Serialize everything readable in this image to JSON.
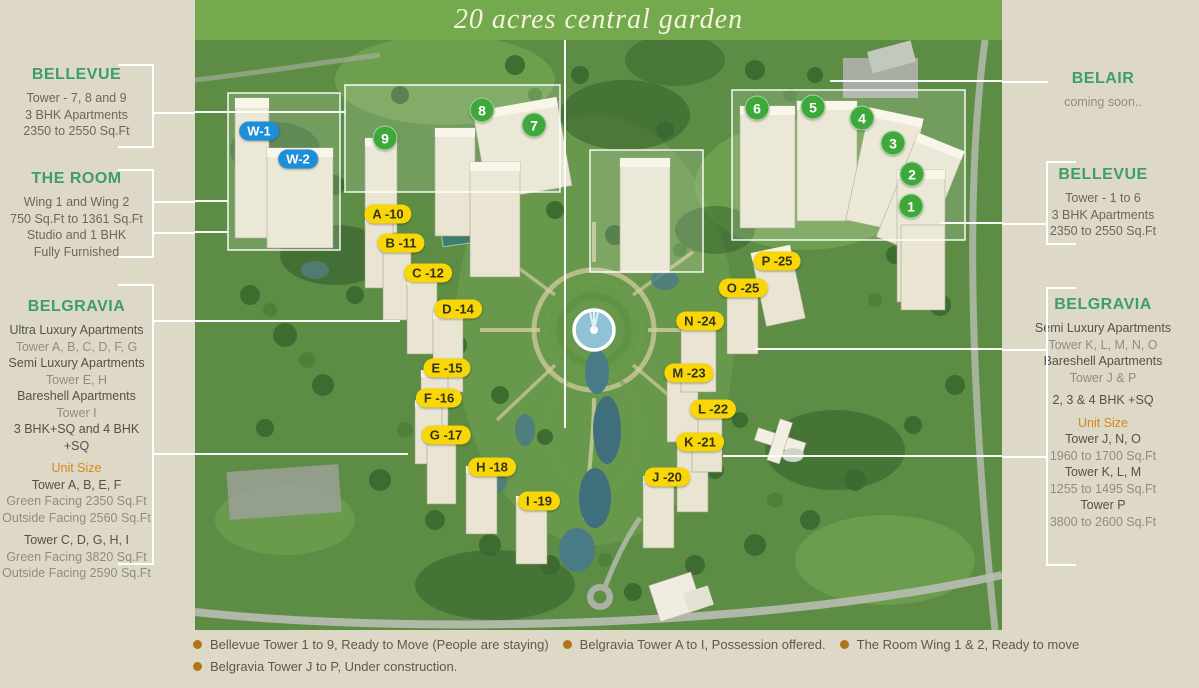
{
  "banner": {
    "title": "20 acres central garden"
  },
  "panels": {
    "left": [
      {
        "id": "bellevue-left",
        "heading": "BELLEVUE",
        "top": 66,
        "lines": [
          {
            "text": "Tower - 7, 8 and 9",
            "tone": "body"
          },
          {
            "text": "3 BHK Apartments",
            "tone": "body"
          },
          {
            "text": "2350 to 2550 Sq.Ft",
            "tone": "body"
          }
        ]
      },
      {
        "id": "the-room",
        "heading": "THE ROOM",
        "top": 170,
        "lines": [
          {
            "text": "Wing 1 and Wing 2",
            "tone": "body"
          },
          {
            "text": "750 Sq.Ft to 1361 Sq.Ft",
            "tone": "body"
          },
          {
            "text": "Studio and 1 BHK",
            "tone": "body"
          },
          {
            "text": "Fully Furnished",
            "tone": "body"
          }
        ]
      },
      {
        "id": "belgravia-left",
        "heading": "BELGRAVIA",
        "top": 298,
        "lines": [
          {
            "text": "Ultra Luxury Apartments",
            "tone": "strong"
          },
          {
            "text": "Tower A, B, C, D, F, G",
            "tone": "muted"
          },
          {
            "text": "Semi Luxury Apartments",
            "tone": "strong"
          },
          {
            "text": "Tower E, H",
            "tone": "muted"
          },
          {
            "text": "Bareshell Apartments",
            "tone": "strong"
          },
          {
            "text": "Tower I",
            "tone": "muted"
          },
          {
            "text": "3 BHK+SQ and 4 BHK +SQ",
            "tone": "strong"
          },
          {
            "text": "Unit Size",
            "tone": "accent",
            "gap": true
          },
          {
            "text": "Tower A, B, E, F",
            "tone": "strong"
          },
          {
            "text": "Green Facing 2350 Sq.Ft",
            "tone": "muted"
          },
          {
            "text": "Outside Facing 2560 Sq.Ft",
            "tone": "muted"
          },
          {
            "text": "Tower C, D, G, H, I",
            "tone": "strong",
            "gap": true
          },
          {
            "text": "Green Facing 3820 Sq.Ft",
            "tone": "muted"
          },
          {
            "text": "Outside Facing 2590 Sq.Ft",
            "tone": "muted"
          }
        ]
      }
    ],
    "right": [
      {
        "id": "belair",
        "heading": "BELAIR",
        "top": 70,
        "lines": [
          {
            "text": "coming soon..",
            "tone": "muted",
            "gap": true
          }
        ]
      },
      {
        "id": "bellevue-right",
        "heading": "BELLEVUE",
        "top": 166,
        "lines": [
          {
            "text": "Tower - 1 to 6",
            "tone": "body",
            "gap": true
          },
          {
            "text": "3 BHK Apartments",
            "tone": "body"
          },
          {
            "text": "2350 to 2550 Sq.Ft",
            "tone": "body"
          }
        ]
      },
      {
        "id": "belgravia-right",
        "heading": "BELGRAVIA",
        "top": 296,
        "lines": [
          {
            "text": "Semi Luxury Apartments",
            "tone": "strong"
          },
          {
            "text": "Tower K, L, M, N, O",
            "tone": "muted"
          },
          {
            "text": "Bareshell Apartments",
            "tone": "strong"
          },
          {
            "text": "Tower J & P",
            "tone": "muted"
          },
          {
            "text": "2, 3 & 4 BHK +SQ",
            "tone": "strong",
            "gap": true
          },
          {
            "text": "Unit Size",
            "tone": "accent",
            "gap": true
          },
          {
            "text": "Tower J, N, O",
            "tone": "strong"
          },
          {
            "text": "1960 to 1700 Sq.Ft",
            "tone": "muted"
          },
          {
            "text": "Tower K, L, M",
            "tone": "strong"
          },
          {
            "text": "1255 to 1495 Sq.Ft",
            "tone": "muted"
          },
          {
            "text": "Tower P",
            "tone": "strong"
          },
          {
            "text": "3800 to 2600 Sq.Ft",
            "tone": "muted"
          }
        ]
      }
    ]
  },
  "map_labels": {
    "belgravia_towers": [
      {
        "text": "A -10",
        "x": 388,
        "y": 214
      },
      {
        "text": "B -11",
        "x": 401,
        "y": 243
      },
      {
        "text": "C -12",
        "x": 428,
        "y": 273
      },
      {
        "text": "D -14",
        "x": 458,
        "y": 309
      },
      {
        "text": "E -15",
        "x": 447,
        "y": 368
      },
      {
        "text": "F -16",
        "x": 439,
        "y": 398
      },
      {
        "text": "G -17",
        "x": 446,
        "y": 435
      },
      {
        "text": "H -18",
        "x": 492,
        "y": 467
      },
      {
        "text": "I -19",
        "x": 539,
        "y": 501
      },
      {
        "text": "J -20",
        "x": 667,
        "y": 477
      },
      {
        "text": "K -21",
        "x": 700,
        "y": 442
      },
      {
        "text": "L -22",
        "x": 713,
        "y": 409
      },
      {
        "text": "M -23",
        "x": 689,
        "y": 373
      },
      {
        "text": "N -24",
        "x": 700,
        "y": 321
      },
      {
        "text": "O -25",
        "x": 743,
        "y": 288
      },
      {
        "text": "P -25",
        "x": 777,
        "y": 261
      }
    ],
    "bellevue_towers": [
      {
        "text": "9",
        "x": 385,
        "y": 138
      },
      {
        "text": "8",
        "x": 482,
        "y": 110
      },
      {
        "text": "7",
        "x": 534,
        "y": 125
      },
      {
        "text": "6",
        "x": 757,
        "y": 108
      },
      {
        "text": "5",
        "x": 813,
        "y": 107
      },
      {
        "text": "4",
        "x": 862,
        "y": 118
      },
      {
        "text": "3",
        "x": 893,
        "y": 143
      },
      {
        "text": "2",
        "x": 912,
        "y": 174
      },
      {
        "text": "1",
        "x": 911,
        "y": 206
      }
    ],
    "room_wings": [
      {
        "text": "W-1",
        "x": 259,
        "y": 131
      },
      {
        "text": "W-2",
        "x": 298,
        "y": 159
      }
    ]
  },
  "legend": {
    "rows": [
      [
        "Bellevue Tower 1 to 9, Ready to Move (People are staying)",
        "Belgravia Tower A to I, Possession offered.",
        "The Room Wing 1 & 2, Ready to move"
      ],
      [
        "Belgravia Tower J to P, Under construction."
      ]
    ]
  },
  "colors": {
    "heading_green": "#3d9e68",
    "accent_orange": "#d4861f",
    "banner_green": "#74a94e",
    "label_yellow": "#f9d606",
    "marker_green": "#3ea83b",
    "wing_blue": "#1d8fd9",
    "bullet_brown": "#b0751c",
    "panel_beige": "#ded9c7"
  }
}
